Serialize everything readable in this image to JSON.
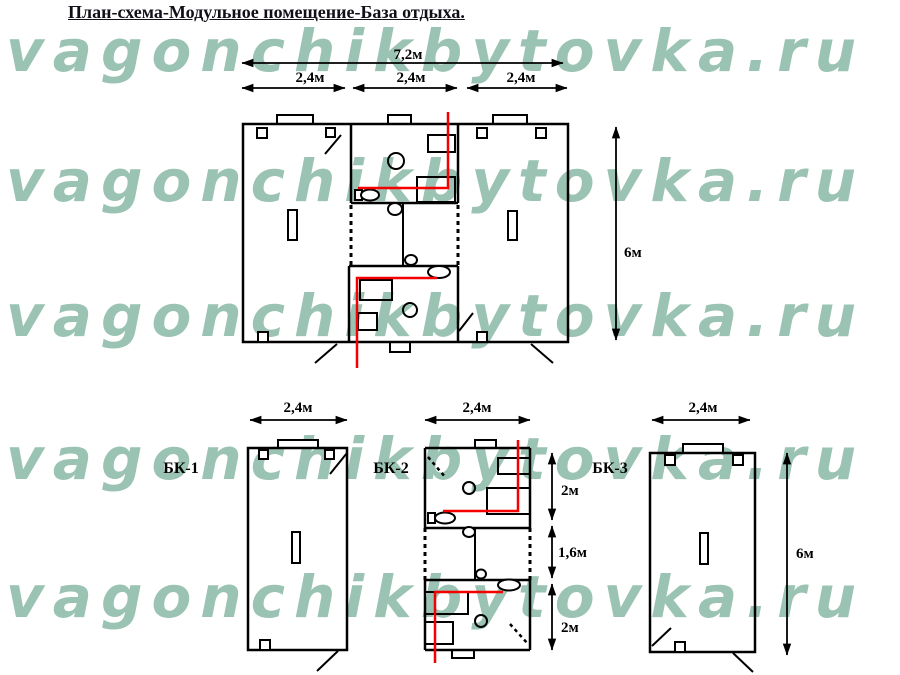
{
  "title": "План-схема-Модульное помещение-База отдыха.",
  "watermark": {
    "text": "vagonchikbytovka.ru",
    "color": "#9ac3b3",
    "rows": 5
  },
  "main_plan": {
    "dim_total_width": "7,2м",
    "dim_sections": [
      "2,4м",
      "2,4м",
      "2,4м"
    ],
    "dim_height": "6м"
  },
  "modules": [
    {
      "label": "БК-1",
      "dim_width": "2,4м"
    },
    {
      "label": "БК-2",
      "dim_width": "2,4м",
      "dim_sections": [
        "2м",
        "1,6м",
        "2м"
      ]
    },
    {
      "label": "БК-3",
      "dim_width": "2,4м",
      "dim_height": "6м"
    }
  ],
  "colors": {
    "line": "#000000",
    "plumbing_line": "#f40000",
    "watermark": "#9ac3b3"
  }
}
